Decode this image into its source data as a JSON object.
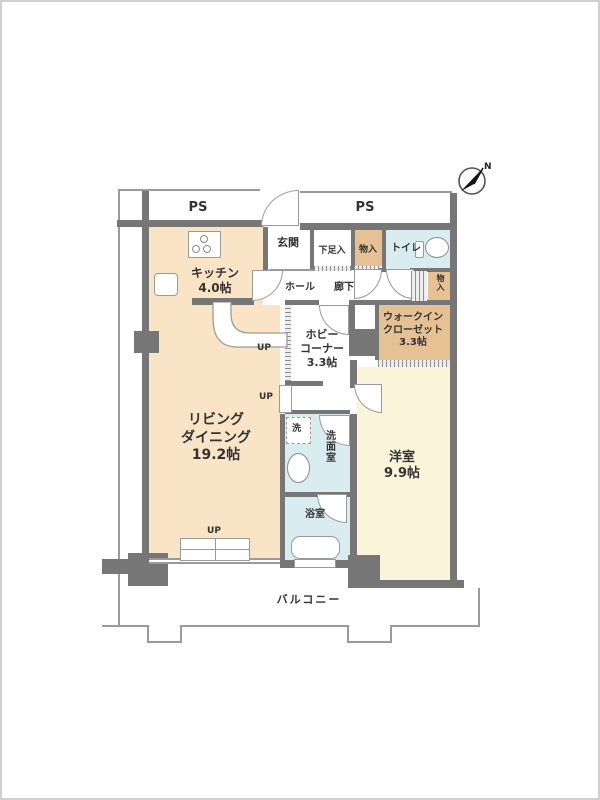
{
  "colors": {
    "wall": "#767676",
    "line": "#9a9a9a",
    "warm_floor": "#f9e4c6",
    "closet": "#e5c193",
    "wet": "#d9edf1",
    "bedroom": "#faf5da"
  },
  "compass": {
    "letter": "N"
  },
  "pipe_spaces": {
    "left": "PS",
    "right": "PS"
  },
  "rooms": {
    "kitchen": {
      "name": "キッチン",
      "size": "4.0帖"
    },
    "entrance": {
      "name": "玄関"
    },
    "shoe_closet": {
      "name": "下足入"
    },
    "storage_top": {
      "name": "物入"
    },
    "toilet": {
      "name": "トイレ"
    },
    "hall": {
      "name": "ホール"
    },
    "corridor": {
      "name": "廊下"
    },
    "storage_side": {
      "name": "物入"
    },
    "hobby_corner": {
      "name_line1": "ホビー",
      "name_line2": "コーナー",
      "size": "3.3帖"
    },
    "walk_in_closet": {
      "name_line1": "ウォークイン",
      "name_line2": "クローゼット",
      "size": "3.3帖"
    },
    "living_dining": {
      "name_line1": "リビング",
      "name_line2": "ダイニング",
      "size": "19.2帖"
    },
    "laundry": {
      "name": "洗"
    },
    "washroom": {
      "name": "洗面室"
    },
    "bathroom": {
      "name": "浴室"
    },
    "western_room": {
      "name": "洋室",
      "size": "9.9帖"
    },
    "balcony": {
      "name": "バルコニー"
    }
  },
  "markers": {
    "up_hobby": "UP",
    "up_hall": "UP",
    "up_living": "UP"
  }
}
